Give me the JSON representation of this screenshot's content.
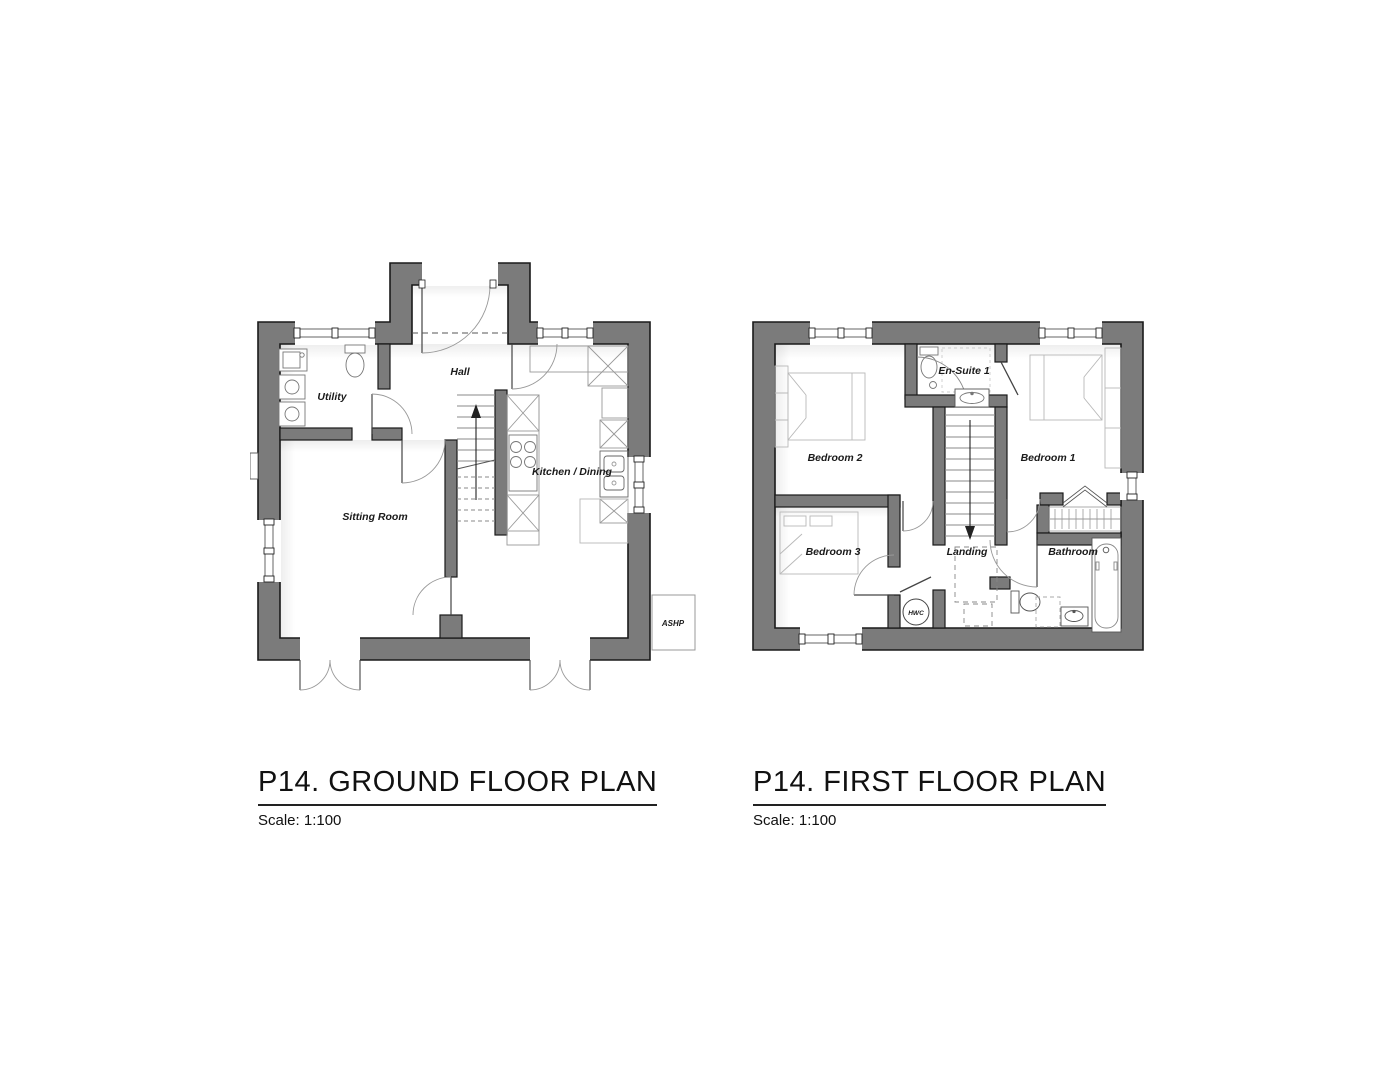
{
  "document": {
    "background": "#ffffff"
  },
  "colors": {
    "wall_fill": "#7b7b7b",
    "wall_outline": "#1a1a1a",
    "fixture_line": "#8a8a8a",
    "furniture_line": "#b8b8b8",
    "text": "#111111"
  },
  "ground_floor": {
    "title": "P14. GROUND FLOOR PLAN",
    "scale": "Scale: 1:100",
    "labels": {
      "utility": "Utility",
      "hall": "Hall",
      "kitchen_dining": "Kitchen / Dining",
      "sitting_room": "Sitting Room",
      "ashp": "ASHP"
    }
  },
  "first_floor": {
    "title": "P14. FIRST FLOOR PLAN",
    "scale": "Scale: 1:100",
    "labels": {
      "bedroom2": "Bedroom 2",
      "ensuite1": "En-Suite 1",
      "bedroom1": "Bedroom 1",
      "bedroom3": "Bedroom 3",
      "landing": "Landing",
      "bathroom": "Bathroom",
      "hwc": "HWC"
    }
  }
}
